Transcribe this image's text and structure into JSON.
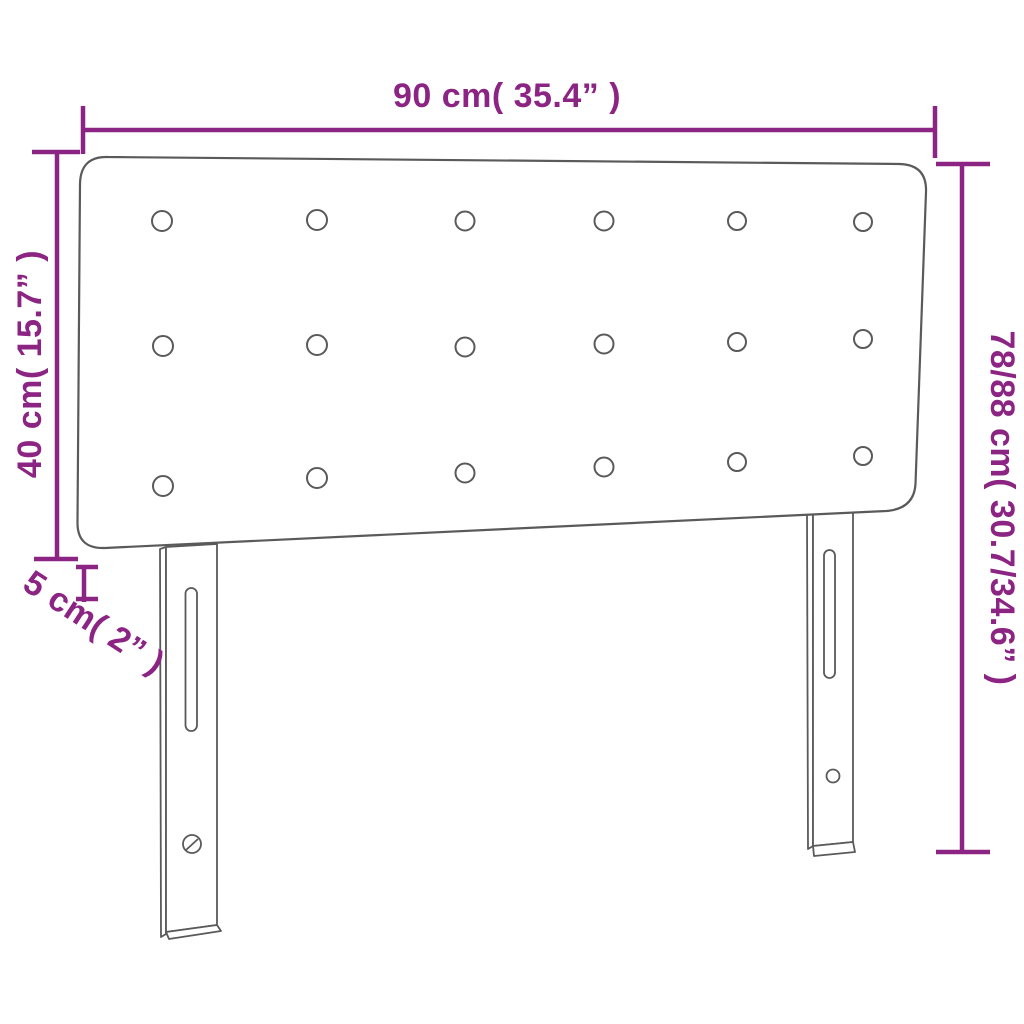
{
  "style": {
    "dimension_color": "#8C2484",
    "outline_color": "#5A5A5A",
    "background_color": "#FFFFFF"
  },
  "diagram": {
    "type": "product-dimension-diagram",
    "subject": "Button-tufted headboard with two slotted mounting legs",
    "button_grid": {
      "rows": 3,
      "columns": 6,
      "total_buttons": 18
    },
    "labels": {
      "width": "90 cm( 35.4” )",
      "headboard_height": "40 cm( 15.7” )",
      "total_height": "78/88 cm( 30.7/34.6” )",
      "depth": "5 cm( 2” )"
    }
  }
}
